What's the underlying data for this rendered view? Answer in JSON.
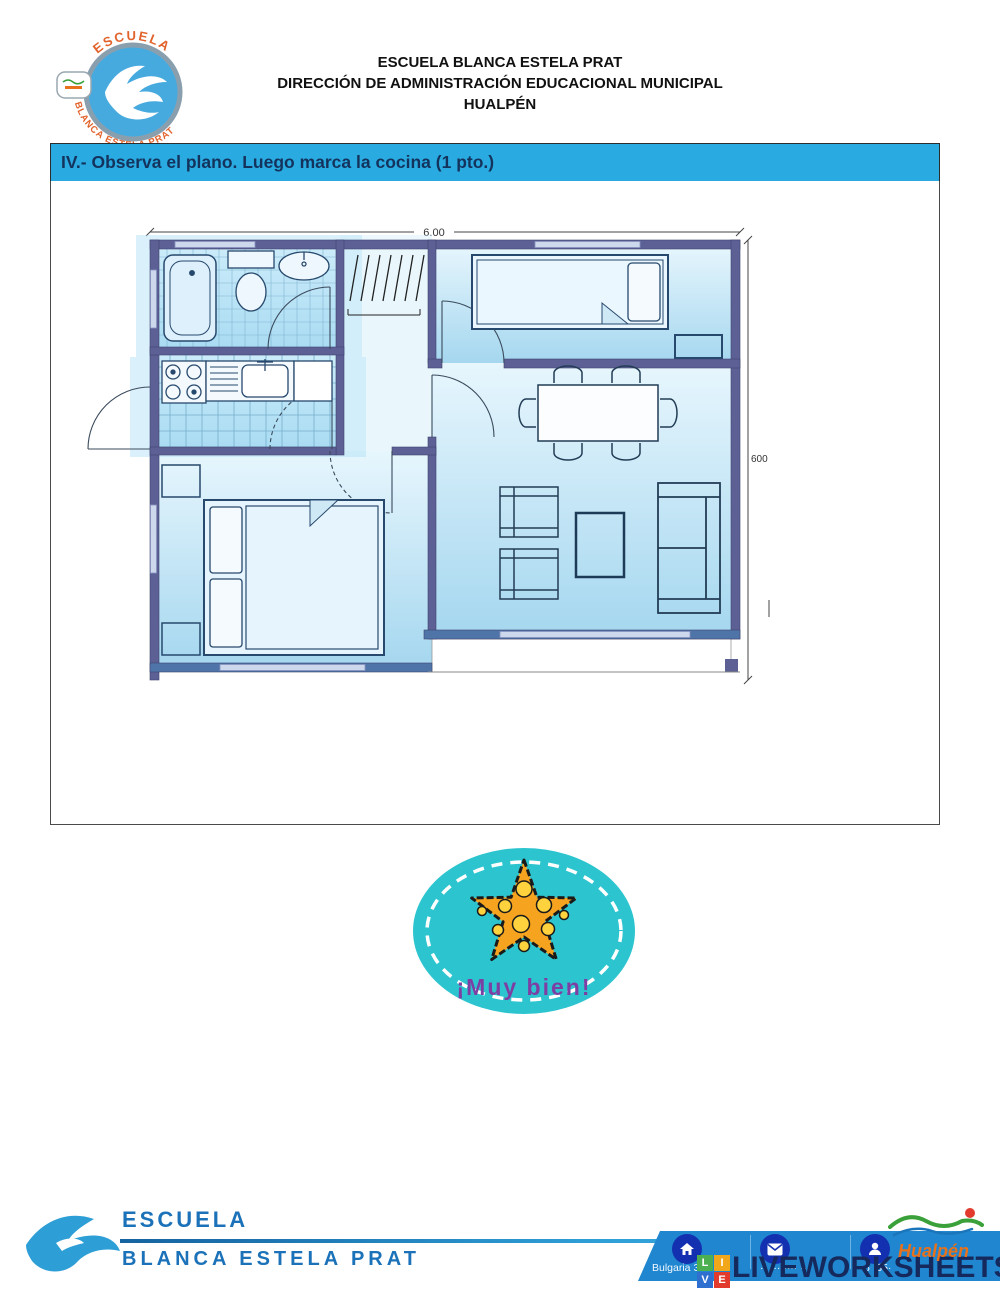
{
  "header": {
    "logo": {
      "top_text": "ESCUELA",
      "bottom_text": "BLANCA ESTELA PRAT"
    },
    "school_lines": [
      "ESCUELA BLANCA ESTELA PRAT",
      "DIRECCIÓN DE ADMINISTRACIÓN EDUCACIONAL MUNICIPAL",
      "HUALPÉN"
    ]
  },
  "task": {
    "title": "IV.- Observa el plano. Luego marca la cocina (1 pto.)",
    "accent_color": "#29abe2"
  },
  "plan": {
    "dim_top": "6.00",
    "dim_right": "600",
    "wall_color": "#5c6094",
    "floor_color": "#bfe3f5"
  },
  "badge": {
    "text": "¡Muy bien!",
    "bg_color": "#2cc5cf",
    "star_color": "#f6a41f",
    "text_color": "#7d3fa3"
  },
  "footer": {
    "school_name_line1": "ESCUELA",
    "school_name_line2": "BLANCA ESTELA PRAT",
    "contact": {
      "address_fragment": "Bulgaria 34",
      "middle_fragment": "·· ··· ···· ··",
      "phone_fragment": "6 ·55·"
    },
    "hualpen_label": "Hualpén",
    "watermark": {
      "blocks": [
        "L",
        "I",
        "V",
        "E"
      ],
      "block_colors": [
        "#4caf50",
        "#f2a71b",
        "#2f6fd0",
        "#e23b2e"
      ],
      "text": "LIVEWORKSHEETS"
    }
  }
}
